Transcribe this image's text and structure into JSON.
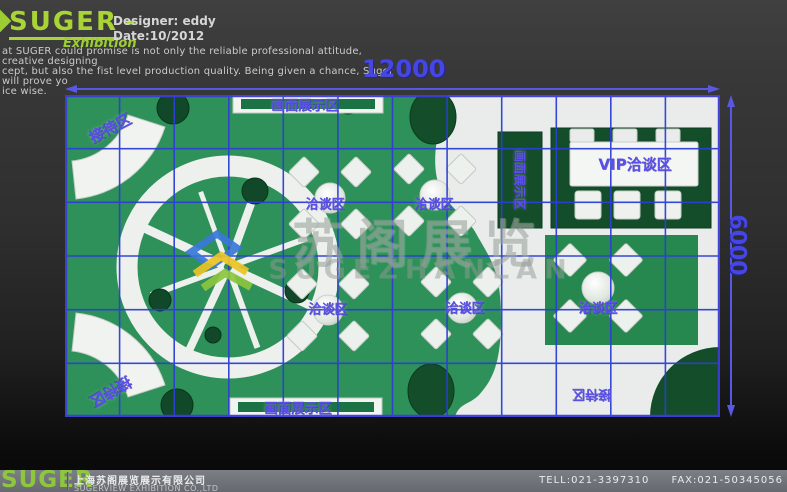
{
  "colors": {
    "accent_green": "#9ccd33",
    "carpet_green": "#2e9159",
    "dark_green": "#134d2a",
    "grid_blue": "#2c3fd4",
    "label_purple": "#5a4fe6",
    "dimension_blue": "#4646e2",
    "footer_gray": "#71757b"
  },
  "header": {
    "logo": {
      "name": "SUGER",
      "dash": "-",
      "subtitle": "Exhibition"
    },
    "designer": "Designer: eddy",
    "date": "Date:10/2012",
    "description_lines": [
      "at SUGER could promise is not only the reliable professional attitude, creative designing",
      "cept, but also the fist level production quality. Being given a chance, Suger will prove yo",
      "ice wise."
    ]
  },
  "dimensions": {
    "width": "12000",
    "height": "6000"
  },
  "plan": {
    "labels": {
      "reception": "接待区",
      "display_wall": "画面展示区",
      "negotiation": "洽谈区",
      "vip": "VIP洽谈区"
    }
  },
  "watermark": {
    "title": "苏阁展览",
    "subtitle": "SUGEZHANLAN"
  },
  "footer": {
    "logo": "SUGER",
    "company_cn": "上海苏阁展览展示有限公司",
    "company_en": "SUGERVIEW EXHIBITION CO.,LTD",
    "tel": "TELL:021-3397310",
    "fax": "FAX:021-50345056"
  }
}
